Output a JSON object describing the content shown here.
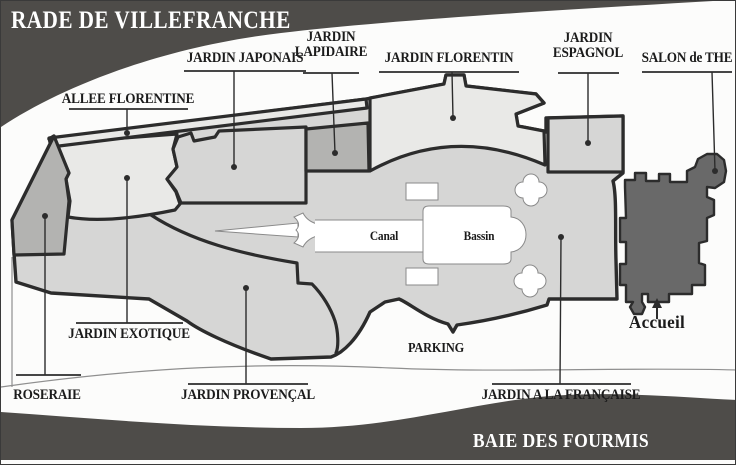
{
  "sea": {
    "top_label": "RADE DE VILLEFRANCHE",
    "bottom_label": "BAIE DES FOURMIS"
  },
  "gardens": {
    "allee_florentine": "ALLEE FLORENTINE",
    "jardin_japonais": "JARDIN JAPONAIS",
    "jardin_lapidaire_l1": "JARDIN",
    "jardin_lapidaire_l2": "LAPIDAIRE",
    "jardin_florentin": "JARDIN FLORENTIN",
    "jardin_espagnol_l1": "JARDIN",
    "jardin_espagnol_l2": "ESPAGNOL",
    "salon_de_the": "SALON de THE",
    "roseraie": "ROSERAIE",
    "jardin_exotique": "JARDIN EXOTIQUE",
    "jardin_provencal": "JARDIN PROVENÇAL",
    "jardin_a_la_francaise": "JARDIN A LA FRANÇAISE",
    "parking": "PARKING",
    "accueil": "Accueil"
  },
  "water_features": {
    "canal": "Canal",
    "bassin": "Bassin"
  },
  "colors": {
    "sea_band": "#4e4c49",
    "villa": "#696969",
    "region_light": "#e9e9e7",
    "region_mid": "#d6d6d5",
    "region_dark": "#b3b3b1",
    "outline": "#2c2c2c",
    "label_text": "#1b1b1b",
    "background": "#fcfcfb"
  }
}
